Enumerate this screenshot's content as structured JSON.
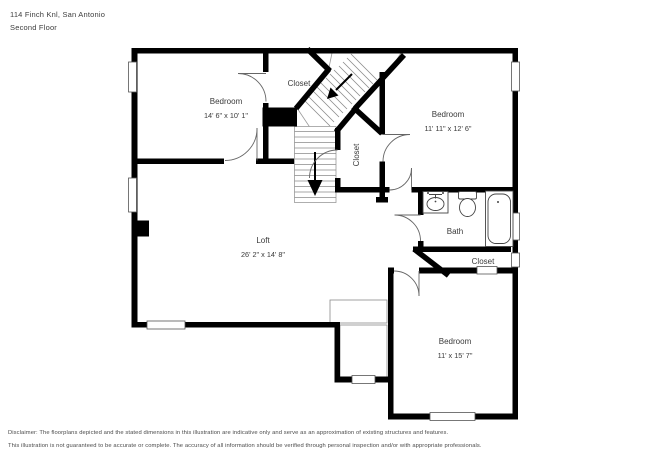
{
  "header": {
    "address": "114 Finch Knl, San Antonio",
    "floor": "Second Floor"
  },
  "rooms": {
    "bedroom_tl": {
      "name": "Bedroom",
      "dims": "14' 6\" x 10' 1\""
    },
    "bedroom_tr": {
      "name": "Bedroom",
      "dims": "11' 11\" x 12' 6\""
    },
    "bedroom_br": {
      "name": "Bedroom",
      "dims": "11' x 15' 7\""
    },
    "loft": {
      "name": "Loft",
      "dims": "26' 2\" x 14' 8\""
    },
    "bath": {
      "name": "Bath"
    },
    "closet_top": {
      "label": "Closet"
    },
    "closet_mid": {
      "label": "Closet"
    },
    "closet_br": {
      "label": "Closet"
    }
  },
  "stairs": {
    "down_arrow": "descend direction"
  },
  "colors": {
    "wall": "#000000",
    "thin_line": "#8a8a8a",
    "text": "#3a3a3a"
  },
  "disclaimer": {
    "line1": "Disclaimer: The floorplans depicted and the stated dimensions in this illustration are indicative only and serve as an approximation of existing structures and features.",
    "line2": "This illustration is not guaranteed to be accurate or complete. The accuracy of all information should be verified through personal inspection and/or with appropriate professionals."
  }
}
